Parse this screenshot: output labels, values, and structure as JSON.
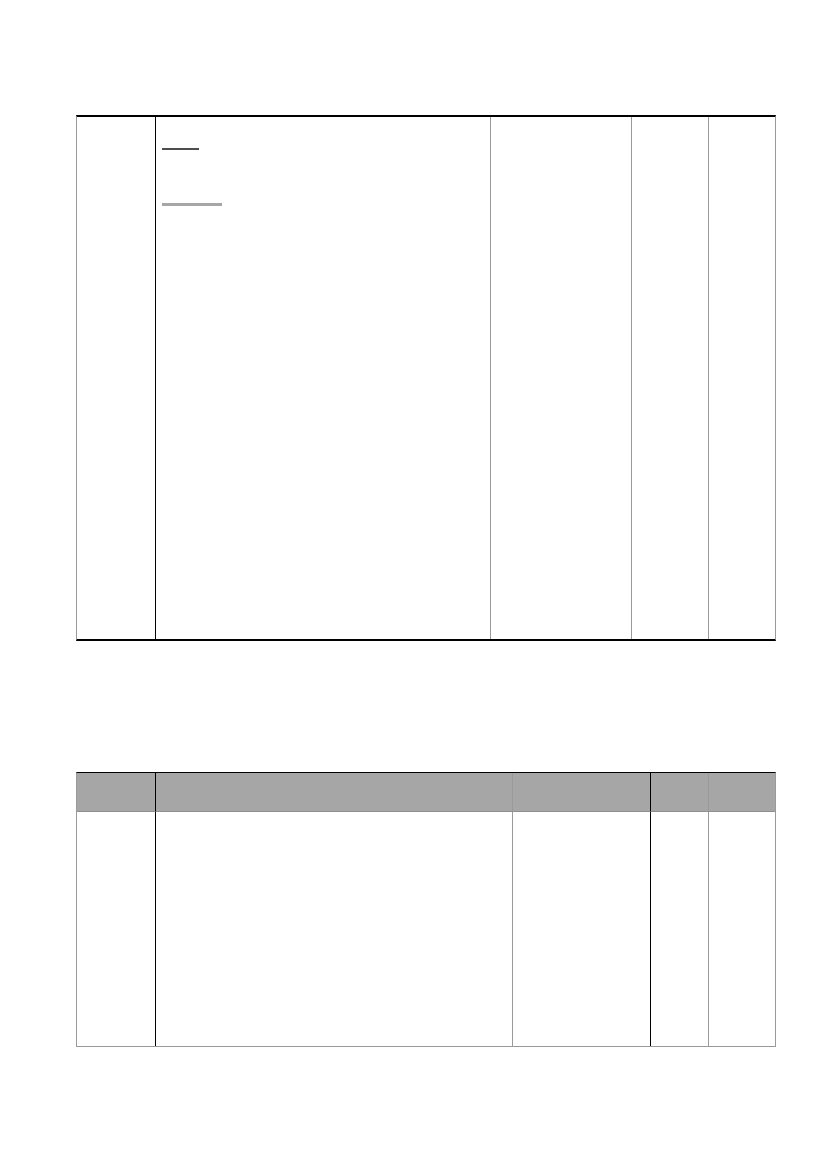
{
  "page": {
    "background_color": "#ffffff"
  },
  "colors": {
    "table_border_black": "#000000",
    "table_border_gray": "#9a9a9a",
    "header_row_fill": "#a6a6a6",
    "underline_mark_dark": "#4d4d4d",
    "underline_mark_light": "#a6a6a6"
  },
  "table1": {
    "type": "table",
    "column_count": 5,
    "header_cells": null,
    "rows": [
      [
        "",
        "",
        "",
        "",
        ""
      ]
    ],
    "placeholders": [
      {
        "kind": "short-dark-underline",
        "text": ""
      },
      {
        "kind": "long-light-underline",
        "text": ""
      }
    ]
  },
  "table2": {
    "type": "table",
    "column_count": 5,
    "header_cells": [
      "",
      "",
      "",
      "",
      ""
    ],
    "rows": [
      [
        "",
        "",
        "",
        "",
        ""
      ]
    ]
  }
}
